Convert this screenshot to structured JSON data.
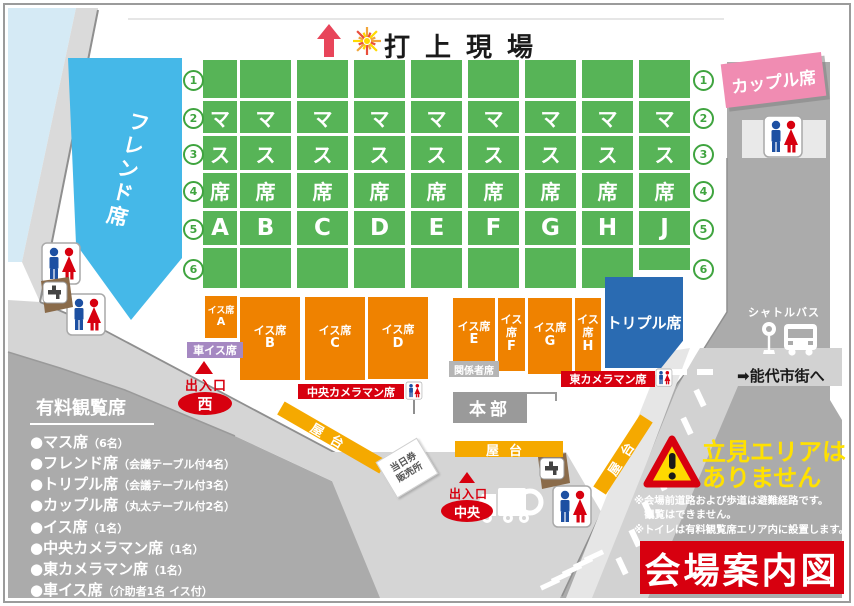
{
  "map_title": "会場案内図",
  "launch_site": {
    "label": "打上現場"
  },
  "colors": {
    "seat_green": "#57B457",
    "green_number": "#3FA43F",
    "friend_blue": "#45B8E8",
    "triple_blue": "#2A6BB2",
    "chair_orange": "#EF8200",
    "yatai_orange": "#F5A900",
    "couple_pink": "#F08CB2",
    "wheelchair_purple": "#A588C2",
    "accent_red": "#D7000F",
    "outside_gray": "#ABABAB",
    "road_light": "#D5D5D5",
    "water_blue": "#D5EAF5",
    "warning_yellow": "#FFE100",
    "hq_gray": "#9A9A9A"
  },
  "masu": {
    "name_chars": [
      "マ",
      "ス",
      "席"
    ],
    "columns": [
      "A",
      "B",
      "C",
      "D",
      "E",
      "F",
      "G",
      "H",
      "J"
    ],
    "row_numbers": [
      "1",
      "2",
      "3",
      "4",
      "5",
      "6"
    ]
  },
  "areas": {
    "friend": "フレンド席",
    "couple": "カップル席",
    "triple": "トリプル席",
    "chair_prefix": "イス席",
    "chair_blocks": [
      "A",
      "B",
      "C",
      "D",
      "E",
      "F",
      "G",
      "H"
    ],
    "wheelchair": "車イス席",
    "officials": "関係者席",
    "headquarters": "本部",
    "center_camera": "中央カメラマン席",
    "east_camera": "東カメラマン席",
    "yatai": "屋台",
    "ticket_booth_line1": "当日券",
    "ticket_booth_line2": "販売所"
  },
  "gates": {
    "west": {
      "label": "出入口",
      "name": "西"
    },
    "center": {
      "label": "出入口",
      "name": "中央"
    }
  },
  "transit": {
    "shuttle": "シャトルバス",
    "to_city": "➡能代市街へ"
  },
  "warning": {
    "line1": "立見エリアは",
    "line2": "ありません",
    "notes": [
      "※会場前道路および歩道は避難経路です。",
      "　観覧はできません。",
      "※トイレは有料観覧席エリア内に設置します。"
    ]
  },
  "legend": {
    "title": "有料観覧席",
    "bullet": "●",
    "items": [
      {
        "name": "マス席",
        "detail": "（6名）"
      },
      {
        "name": "フレンド席",
        "detail": "（会議テーブル付4名）"
      },
      {
        "name": "トリプル席",
        "detail": "（会議テーブル付3名）"
      },
      {
        "name": "カップル席",
        "detail": "（丸太テーブル付2名）"
      },
      {
        "name": "イス席",
        "detail": "（1名）"
      },
      {
        "name": "中央カメラマン席",
        "detail": "（1名）"
      },
      {
        "name": "東カメラマン席",
        "detail": "（1名）"
      },
      {
        "name": "車イス席",
        "detail": "（介助者1名 イス付）"
      }
    ]
  }
}
